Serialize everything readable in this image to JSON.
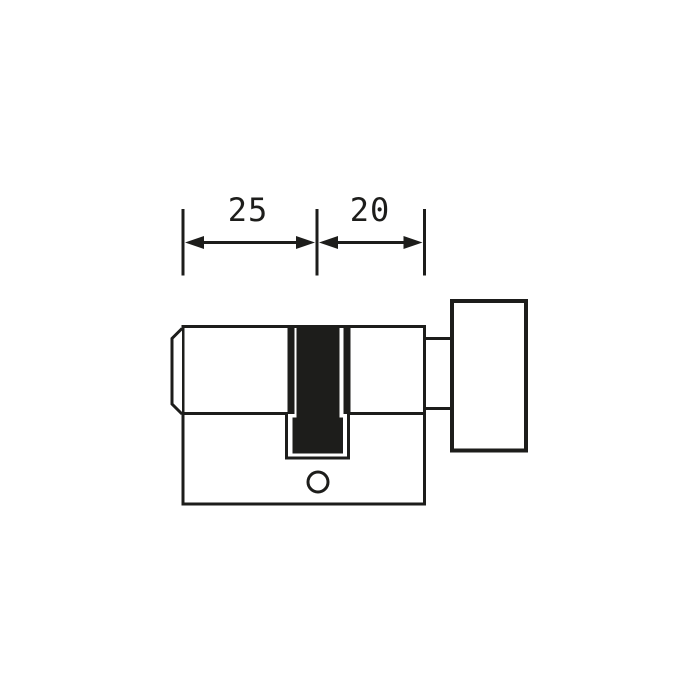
{
  "diagram": {
    "type": "technical-drawing",
    "subject": "knob-cylinder-lock-profile",
    "colors": {
      "ink": "#1d1d1b",
      "background": "#ffffff",
      "cam_fill": "#1d1d1b"
    },
    "dimensions": {
      "left": {
        "value": "25"
      },
      "right": {
        "value": "20"
      }
    }
  }
}
